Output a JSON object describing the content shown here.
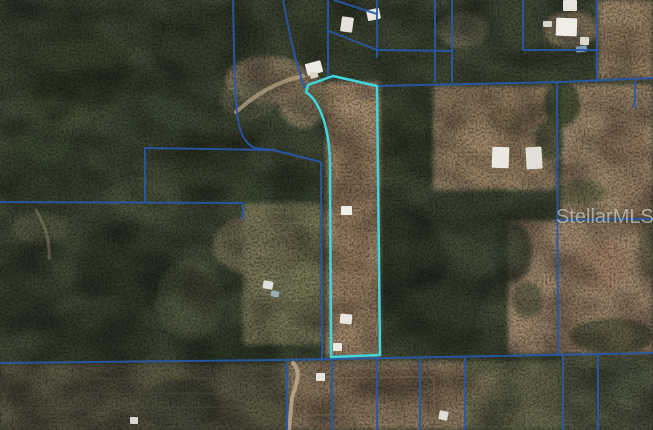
{
  "watermark": {
    "text": "StellarMLS"
  },
  "palette": {
    "base_forest": "#424b36",
    "boundary_line": "#2659ac",
    "subject_outline": "#3fd6de"
  },
  "map": {
    "subject_parcel_path": "M333,76 L377,86 L380,355 L331,357 L330,162 C329,127 320,102 306,92 L308,85 Z",
    "boundaries": [
      "M233,0 C234,60 235,100 238,120 Q242,143 255,148 L273,150 L321,162",
      "M145,148 L273,150",
      "M145,148 L145,202",
      "M0,202 L243,203",
      "M243,203 L243,220",
      "M321,162 L322,361",
      "M328,0 L328,78",
      "M329,31 L377,50",
      "M377,0 L377,58",
      "M334,0 L377,14",
      "M377,50 L452,51",
      "M435,0 L435,82",
      "M452,0 L452,82",
      "M378,86 L560,82 L653,78",
      "M523,0 L523,50",
      "M523,50 L597,50",
      "M597,0 L597,82",
      "M635,81 L635,108",
      "M557,83 L558,355",
      "M558,220 L653,219",
      "M0,363 L280,360 L653,353",
      "M287,362 L287,430",
      "M332,360 L332,430",
      "M377,359 L377,430",
      "M420,359 L420,430",
      "M465,358 L465,430",
      "M563,356 L563,430",
      "M598,355 L598,430",
      "M283,0 C291,42 299,74 305,88"
    ],
    "forest_blobs": [
      {
        "cx": 70,
        "cy": 70,
        "rx": 60,
        "ry": 45,
        "fill": "#323c29",
        "o": 0.6
      },
      {
        "cx": 200,
        "cy": 45,
        "rx": 50,
        "ry": 35,
        "fill": "#2e3826",
        "o": 0.6
      },
      {
        "cx": 45,
        "cy": 165,
        "rx": 45,
        "ry": 35,
        "fill": "#37422c",
        "o": 0.6
      },
      {
        "cx": 130,
        "cy": 265,
        "rx": 55,
        "ry": 45,
        "fill": "#2f3927",
        "o": 0.6
      },
      {
        "cx": 210,
        "cy": 160,
        "rx": 45,
        "ry": 35,
        "fill": "#333e2a",
        "o": 0.55
      },
      {
        "cx": 95,
        "cy": 340,
        "rx": 60,
        "ry": 35,
        "fill": "#2c3624",
        "o": 0.6
      },
      {
        "cx": 280,
        "cy": 200,
        "rx": 35,
        "ry": 30,
        "fill": "#343f2b",
        "o": 0.5
      },
      {
        "cx": 415,
        "cy": 140,
        "rx": 45,
        "ry": 40,
        "fill": "#313b28",
        "o": 0.6
      },
      {
        "cx": 405,
        "cy": 265,
        "rx": 40,
        "ry": 55,
        "fill": "#2e3826",
        "o": 0.6
      },
      {
        "cx": 240,
        "cy": 352,
        "rx": 45,
        "ry": 22,
        "fill": "#2b3523",
        "o": 0.6
      },
      {
        "cx": 25,
        "cy": 290,
        "rx": 35,
        "ry": 40,
        "fill": "#313c28",
        "o": 0.55
      },
      {
        "cx": 330,
        "cy": 25,
        "rx": 30,
        "ry": 20,
        "fill": "#38422d",
        "o": 0.5
      },
      {
        "cx": 500,
        "cy": 90,
        "rx": 35,
        "ry": 25,
        "fill": "#364128",
        "o": 0.5
      },
      {
        "cx": 440,
        "cy": 330,
        "rx": 45,
        "ry": 30,
        "fill": "#2d3725",
        "o": 0.6
      },
      {
        "cx": 160,
        "cy": 115,
        "rx": 40,
        "ry": 30,
        "fill": "#3a452f",
        "o": 0.5
      },
      {
        "cx": 145,
        "cy": 200,
        "rx": 35,
        "ry": 22,
        "fill": "#5a6545",
        "o": 0.4
      },
      {
        "cx": 300,
        "cy": 250,
        "rx": 20,
        "ry": 18,
        "fill": "#5f694a",
        "o": 0.4
      },
      {
        "cx": 480,
        "cy": 60,
        "rx": 25,
        "ry": 18,
        "fill": "#5c664a",
        "o": 0.4
      },
      {
        "cx": 60,
        "cy": 115,
        "rx": 28,
        "ry": 18,
        "fill": "#55603f",
        "o": 0.35
      }
    ],
    "fields": [
      {
        "x": 598,
        "y": 0,
        "w": 55,
        "h": 79,
        "fill": "#a28a6e",
        "o": 0.95
      },
      {
        "x": 561,
        "y": 84,
        "w": 92,
        "h": 134,
        "fill": "#a78f73",
        "o": 0.95
      },
      {
        "x": 508,
        "y": 221,
        "w": 145,
        "h": 133,
        "fill": "#a98e74",
        "o": 0.95
      },
      {
        "x": 433,
        "y": 86,
        "w": 124,
        "h": 104,
        "fill": "#9f896b",
        "o": 0.92
      },
      {
        "cx": 268,
        "cy": 80,
        "rx": 42,
        "ry": 24,
        "fill": "#a28c70",
        "o": 0.75
      },
      {
        "cx": 303,
        "cy": 100,
        "rx": 25,
        "ry": 28,
        "fill": "#9a886c",
        "o": 0.75
      },
      {
        "cx": 248,
        "cy": 100,
        "rx": 28,
        "ry": 20,
        "fill": "#7e7a5e",
        "o": 0.55
      },
      {
        "x": 243,
        "y": 203,
        "w": 79,
        "h": 142,
        "fill": "#85815f",
        "o": 0.85
      },
      {
        "cx": 255,
        "cy": 245,
        "rx": 42,
        "ry": 30,
        "fill": "#8f8468",
        "o": 0.6
      },
      {
        "cx": 300,
        "cy": 320,
        "rx": 26,
        "ry": 26,
        "fill": "#77765a",
        "o": 0.6
      },
      {
        "cx": 190,
        "cy": 300,
        "rx": 34,
        "ry": 40,
        "fill": "#5e6547",
        "o": 0.55
      },
      {
        "x": 326,
        "y": 82,
        "w": 54,
        "h": 276,
        "fill": "#a3896c",
        "o": 1
      },
      {
        "cx": 352,
        "cy": 230,
        "rx": 16,
        "ry": 90,
        "fill": "#8d7458",
        "o": 0.5
      },
      {
        "cx": 352,
        "cy": 112,
        "rx": 19,
        "ry": 28,
        "fill": "#b09778",
        "o": 0.55
      },
      {
        "cx": 495,
        "cy": 160,
        "rx": 50,
        "ry": 27,
        "fill": "#ab9070",
        "o": 0.65
      },
      {
        "cx": 505,
        "cy": 118,
        "rx": 17,
        "ry": 14,
        "fill": "#6b6142",
        "o": 0.6
      },
      {
        "cx": 462,
        "cy": 30,
        "rx": 26,
        "ry": 18,
        "fill": "#847c60",
        "o": 0.55
      },
      {
        "cx": 571,
        "cy": 30,
        "rx": 27,
        "ry": 19,
        "fill": "#9f8c70",
        "o": 0.8
      },
      {
        "cx": 620,
        "cy": 35,
        "rx": 17,
        "ry": 12,
        "fill": "#8a7258",
        "o": 0.6
      },
      {
        "x": 0,
        "y": 364,
        "w": 288,
        "h": 66,
        "fill": "#5f5c47",
        "o": 0.95
      },
      {
        "x": 288,
        "y": 361,
        "w": 178,
        "h": 69,
        "fill": "#917d64",
        "o": 0.95
      },
      {
        "x": 302,
        "y": 372,
        "w": 140,
        "h": 46,
        "fill": "#826e57",
        "o": 0.5
      },
      {
        "x": 466,
        "y": 361,
        "w": 95,
        "h": 69,
        "fill": "#6e6e52",
        "o": 0.9
      },
      {
        "x": 560,
        "y": 357,
        "w": 93,
        "h": 73,
        "fill": "#5d5f4a",
        "o": 0.95
      },
      {
        "cx": 483,
        "cy": 388,
        "rx": 18,
        "ry": 14,
        "fill": "#8d7a5f",
        "o": 0.55
      },
      {
        "cx": 40,
        "cy": 228,
        "rx": 28,
        "ry": 16,
        "fill": "#6a6b4e",
        "o": 0.45
      },
      {
        "cx": 622,
        "cy": 145,
        "rx": 24,
        "ry": 20,
        "fill": "#997a60",
        "o": 0.45
      },
      {
        "cx": 600,
        "cy": 265,
        "rx": 30,
        "ry": 26,
        "fill": "#9b7b62",
        "o": 0.45
      },
      {
        "cx": 636,
        "cy": 205,
        "rx": 16,
        "ry": 24,
        "fill": "#8f7258",
        "o": 0.35
      }
    ],
    "tree_clumps": [
      {
        "cx": 562,
        "cy": 103,
        "rx": 18,
        "ry": 24,
        "fill": "#39442d",
        "o": 0.8
      },
      {
        "cx": 549,
        "cy": 140,
        "rx": 14,
        "ry": 20,
        "fill": "#3c462e",
        "o": 0.7
      },
      {
        "cx": 512,
        "cy": 252,
        "rx": 20,
        "ry": 30,
        "fill": "#37422c",
        "o": 0.75
      },
      {
        "cx": 528,
        "cy": 300,
        "rx": 15,
        "ry": 18,
        "fill": "#3c462e",
        "o": 0.55
      },
      {
        "cx": 612,
        "cy": 336,
        "rx": 42,
        "ry": 18,
        "fill": "#39432c",
        "o": 0.65
      },
      {
        "cx": 429,
        "cy": 52,
        "rx": 20,
        "ry": 17,
        "fill": "#36402b",
        "o": 0.7
      },
      {
        "cx": 536,
        "cy": 57,
        "rx": 15,
        "ry": 16,
        "fill": "#39432c",
        "o": 0.6
      },
      {
        "cx": 578,
        "cy": 192,
        "rx": 28,
        "ry": 12,
        "fill": "#424d31",
        "o": 0.4
      },
      {
        "cx": 618,
        "cy": 378,
        "rx": 28,
        "ry": 20,
        "fill": "#454e38",
        "o": 0.55
      },
      {
        "cx": 505,
        "cy": 396,
        "rx": 20,
        "ry": 16,
        "fill": "#4e553e",
        "o": 0.45
      },
      {
        "cx": 180,
        "cy": 405,
        "rx": 40,
        "ry": 26,
        "fill": "#3a4130",
        "o": 0.6
      },
      {
        "cx": 75,
        "cy": 400,
        "rx": 30,
        "ry": 18,
        "fill": "#4c4c3a",
        "o": 0.45
      },
      {
        "cx": 648,
        "cy": 248,
        "rx": 10,
        "ry": 30,
        "fill": "#4a5236",
        "o": 0.4
      }
    ],
    "row_lines": [
      {
        "x1": 4,
        "y1": 379,
        "x2": 278,
        "y2": 378,
        "c": "#4b4936",
        "w": 1.3,
        "o": 0.5
      },
      {
        "x1": 4,
        "y1": 394,
        "x2": 278,
        "y2": 393,
        "c": "#4b4936",
        "w": 1.3,
        "o": 0.5
      },
      {
        "x1": 6,
        "y1": 408,
        "x2": 280,
        "y2": 407,
        "c": "#4b4936",
        "w": 1.3,
        "o": 0.5
      },
      {
        "x1": 250,
        "y1": 213,
        "x2": 320,
        "y2": 212,
        "c": "#6f6a50",
        "w": 1.2,
        "o": 0.5
      },
      {
        "x1": 247,
        "y1": 224,
        "x2": 320,
        "y2": 223,
        "c": "#6f6a50",
        "w": 1.2,
        "o": 0.5
      }
    ],
    "roads": [
      {
        "d": "M236,112 C255,95 275,82 303,76",
        "c": "#b4a083",
        "w": 4,
        "o": 0.75
      },
      {
        "d": "M293,363 C302,372 296,384 292,398 L289,430",
        "c": "#bfae90",
        "w": 4,
        "o": 0.8
      },
      {
        "d": "M36,210 C44,224 50,238 49,258",
        "c": "#8c856a",
        "w": 3,
        "o": 0.45
      },
      {
        "d": "M306,378 L434,377 L434,414 L306,415 Z",
        "c": "#7d6a53",
        "w": 1.4,
        "o": 0.5
      }
    ],
    "structures": [
      {
        "x": 306,
        "y": 62,
        "w": 16,
        "h": 12,
        "fill": "#ecebe3",
        "rot": -15
      },
      {
        "x": 310,
        "y": 72,
        "w": 8,
        "h": 6,
        "fill": "#d9d5c9",
        "rot": -15
      },
      {
        "x": 341,
        "y": 17,
        "w": 12,
        "h": 15,
        "fill": "#e4e1d8",
        "rot": 8
      },
      {
        "x": 367,
        "y": 9,
        "w": 13,
        "h": 11,
        "fill": "#eae7de",
        "rot": -12
      },
      {
        "x": 556,
        "y": 18,
        "w": 21,
        "h": 18,
        "fill": "#efede6",
        "rot": 2
      },
      {
        "x": 580,
        "y": 37,
        "w": 9,
        "h": 8,
        "fill": "#dcd9ce",
        "rot": 2
      },
      {
        "x": 563,
        "y": 0,
        "w": 14,
        "h": 11,
        "fill": "#e6e3da",
        "rot": 0
      },
      {
        "x": 576,
        "y": 46,
        "w": 11,
        "h": 6,
        "fill": "#7f9ab5",
        "rot": -8
      },
      {
        "x": 543,
        "y": 21,
        "w": 9,
        "h": 6,
        "fill": "#d7d5ca",
        "rot": 0
      },
      {
        "x": 492,
        "y": 147,
        "w": 17,
        "h": 21,
        "fill": "#eae8e0",
        "rot": 2
      },
      {
        "x": 526,
        "y": 147,
        "w": 16,
        "h": 22,
        "fill": "#e2e0d6",
        "rot": -3
      },
      {
        "x": 341,
        "y": 206,
        "w": 11,
        "h": 9,
        "fill": "#f0eee8",
        "rot": 0
      },
      {
        "x": 340,
        "y": 314,
        "w": 12,
        "h": 10,
        "fill": "#e8e6de",
        "rot": 5
      },
      {
        "x": 333,
        "y": 343,
        "w": 9,
        "h": 8,
        "fill": "#eceae2",
        "rot": 0
      },
      {
        "x": 263,
        "y": 281,
        "w": 10,
        "h": 8,
        "fill": "#dfe0da",
        "rot": 10
      },
      {
        "x": 271,
        "y": 291,
        "w": 8,
        "h": 6,
        "fill": "#9cadb4",
        "rot": 10
      },
      {
        "x": 316,
        "y": 373,
        "w": 9,
        "h": 8,
        "fill": "#e6e4dc",
        "rot": 0
      },
      {
        "x": 439,
        "y": 411,
        "w": 9,
        "h": 9,
        "fill": "#dcdcd4",
        "rot": 12
      },
      {
        "x": 130,
        "y": 417,
        "w": 8,
        "h": 7,
        "fill": "#d8d8d0",
        "rot": 0
      }
    ]
  }
}
